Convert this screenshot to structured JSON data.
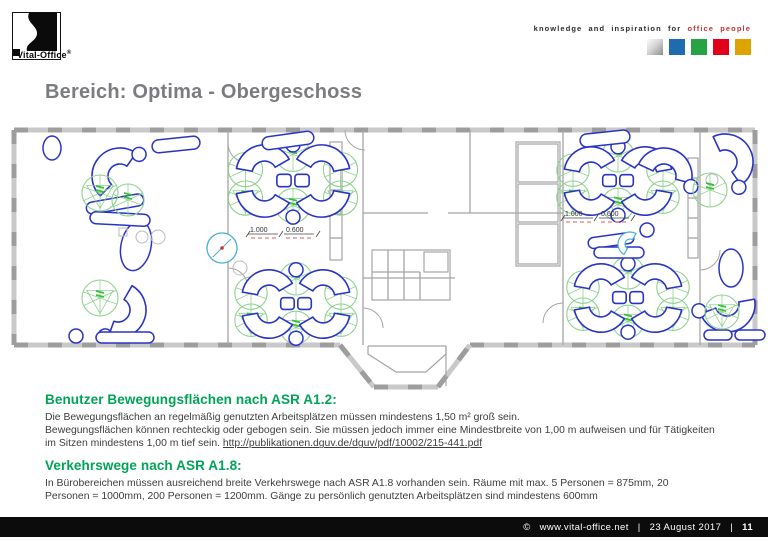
{
  "header": {
    "logo_text": "Vital-Office",
    "logo_reg": "®",
    "kicker_plain": "knowledge and inspiration for",
    "kicker_accent": "office people",
    "square_colors": [
      "silver",
      "#1e6bb0",
      "#27a244",
      "#e2001a",
      "#dda400"
    ]
  },
  "title": "Bereich: Optima - Obergeschoss",
  "sections": [
    {
      "heading": "Benutzer Bewegungsflächen nach ASR A1.2:",
      "line1": "Die Bewegungsflächen an regelmäßig genutzten Arbeitsplätzen müssen mindestens 1,50 m² groß sein.",
      "line2": "Bewegungsflächen können rechteckig oder gebogen sein. Sie müssen jedoch immer eine Mindestbreite von 1,00 m aufweisen und für Tätigkeiten",
      "line3_prefix": "im Sitzen mindestens 1,00 m tief sein. ",
      "link": "http://publikationen.dguv.de/dguv/pdf/10002/215-441.pdf"
    },
    {
      "heading": "Verkehrswege nach ASR A1.8:",
      "line1": "In Bürobereichen müssen ausreichend breite Verkehrswege nach ASR A1.8 vorhanden sein. Räume mit max. 5 Personen = 875mm, 20",
      "line2": "Personen = 1000mm, 200 Personen = 1200mm. Gänge zu persönlich genutzten Arbeitsplätzen sind mindestens 600mm"
    }
  ],
  "footer": {
    "copyright": "©",
    "site": "www.vital-office.net",
    "sep": "|",
    "date": "23 August 2017",
    "page": "11"
  },
  "colors": {
    "heading_green": "#00a455",
    "desk_blue": "#2a34c4",
    "zone_green": "#8ed28e",
    "zone_mark_green": "#38c038",
    "wall_gray": "#c9c9c9",
    "wall_dark": "#9d9d9d",
    "inner_gray": "#a5a5a5",
    "cyan": "#4ab0d2",
    "accent_red": "#cc3333"
  },
  "floorplan": {
    "walls": [
      [
        14,
        12,
        755,
        12
      ],
      [
        14,
        12,
        14,
        227
      ],
      [
        755,
        12,
        755,
        227
      ],
      [
        14,
        227,
        340,
        227
      ],
      [
        470,
        227,
        755,
        227
      ],
      [
        340,
        227,
        374,
        269
      ],
      [
        374,
        269,
        438,
        269
      ],
      [
        438,
        269,
        470,
        227
      ]
    ],
    "inner_walls": [
      [
        228,
        12,
        228,
        227
      ],
      [
        363,
        12,
        363,
        227
      ],
      [
        563,
        12,
        563,
        227
      ],
      [
        700,
        12,
        700,
        227
      ],
      [
        363,
        95,
        428,
        95
      ],
      [
        448,
        95,
        563,
        95
      ],
      [
        363,
        160,
        455,
        160
      ],
      [
        470,
        12,
        470,
        95
      ],
      [
        330,
        48,
        342,
        48
      ],
      [
        330,
        72,
        342,
        72
      ],
      [
        330,
        96,
        342,
        96
      ],
      [
        330,
        120,
        342,
        120
      ],
      [
        688,
        60,
        698,
        60
      ],
      [
        688,
        80,
        698,
        80
      ],
      [
        688,
        100,
        698,
        100
      ],
      [
        688,
        120,
        698,
        120
      ],
      [
        388,
        132,
        388,
        182
      ],
      [
        404,
        132,
        404,
        182
      ],
      [
        420,
        154,
        420,
        182
      ],
      [
        372,
        154,
        420,
        154
      ]
    ],
    "rects": [
      [
        330,
        24,
        12,
        118
      ],
      [
        516,
        24,
        44,
        124
      ],
      [
        518,
        26,
        40,
        38
      ],
      [
        518,
        66,
        40,
        38
      ],
      [
        518,
        106,
        40,
        40
      ],
      [
        688,
        40,
        10,
        100
      ],
      [
        372,
        132,
        78,
        50
      ],
      [
        424,
        134,
        24,
        20
      ]
    ],
    "plines": [
      [
        [
          368,
          228
        ],
        [
          368,
          236
        ],
        [
          396,
          254
        ],
        [
          426,
          254
        ],
        [
          446,
          236
        ],
        [
          446,
          228
        ]
      ],
      [
        [
          368,
          228
        ],
        [
          446,
          228
        ]
      ],
      [
        [
          446,
          228
        ],
        [
          446,
          268
        ]
      ]
    ],
    "doors": [
      "M345,12 A20,20 0 0 0 365,32",
      "M720,132 A20,20 0 0 1 700,152",
      "M228,25 A20,20 0 0 0 248,45",
      "M228,150 A20,20 0 0 1 248,170",
      "M363,190 A20,20 0 0 1 383,210",
      "M563,185 A20,20 0 0 0 543,205"
    ],
    "clusters": [
      {
        "type": "quad",
        "cx": 293,
        "cy": 63,
        "s": 0.95
      },
      {
        "type": "quad",
        "cx": 296,
        "cy": 186,
        "s": 0.9
      },
      {
        "type": "quad",
        "cx": 618,
        "cy": 63,
        "s": 0.9
      },
      {
        "type": "quad",
        "cx": 628,
        "cy": 180,
        "s": 0.9
      },
      {
        "type": "single",
        "cx": 120,
        "cy": 58,
        "rot": -15
      },
      {
        "type": "single",
        "cx": 118,
        "cy": 192,
        "rot": 150
      },
      {
        "type": "single",
        "cx": 664,
        "cy": 58,
        "rot": 55
      },
      {
        "type": "single",
        "cx": 725,
        "cy": 44,
        "rot": 95
      },
      {
        "type": "single",
        "cx": 727,
        "cy": 186,
        "rot": 200
      }
    ],
    "shapes": [
      {
        "t": "ellipse",
        "x": 52,
        "y": 30,
        "rx": 9,
        "ry": 12,
        "rot": 0
      },
      {
        "t": "ellipse",
        "x": 136,
        "y": 128,
        "rx": 15,
        "ry": 25,
        "rot": 12
      },
      {
        "t": "ellipse",
        "x": 731,
        "y": 150,
        "rx": 12,
        "ry": 19,
        "rot": 0
      },
      {
        "t": "rrect",
        "x": 86,
        "y": 80,
        "w": 58,
        "h": 12,
        "rot": -10
      },
      {
        "t": "rrect",
        "x": 90,
        "y": 95,
        "w": 60,
        "h": 12,
        "rot": 3
      },
      {
        "t": "rrect",
        "x": 96,
        "y": 214,
        "w": 58,
        "h": 11,
        "rot": 0
      },
      {
        "t": "rrect",
        "x": 152,
        "y": 20,
        "w": 48,
        "h": 13,
        "rot": -6
      },
      {
        "t": "rrect",
        "x": 262,
        "y": 16,
        "w": 52,
        "h": 13,
        "rot": -8
      },
      {
        "t": "rrect",
        "x": 580,
        "y": 14,
        "w": 50,
        "h": 13,
        "rot": -6
      },
      {
        "t": "rrect",
        "x": 588,
        "y": 117,
        "w": 46,
        "h": 11,
        "rot": -8
      },
      {
        "t": "rrect",
        "x": 594,
        "y": 129,
        "w": 50,
        "h": 11,
        "rot": 0
      },
      {
        "t": "rrect",
        "x": 704,
        "y": 212,
        "w": 28,
        "h": 10,
        "rot": 0
      },
      {
        "t": "rrect",
        "x": 735,
        "y": 212,
        "w": 30,
        "h": 10,
        "rot": 0
      },
      {
        "t": "chair",
        "x": 76,
        "y": 218
      },
      {
        "t": "chair",
        "x": 647,
        "y": 112
      },
      {
        "t": "gsq",
        "x": 123,
        "y": 114,
        "s": 8
      },
      {
        "t": "gcirc",
        "x": 142,
        "y": 119,
        "r": 6
      },
      {
        "t": "gcirc",
        "x": 158,
        "y": 119,
        "r": 7
      },
      {
        "t": "gcirc",
        "x": 240,
        "y": 150,
        "r": 7
      },
      {
        "t": "gcirc",
        "x": 712,
        "y": 62,
        "r": 6
      },
      {
        "t": "table",
        "x": 222,
        "y": 130,
        "r": 15
      },
      {
        "t": "cyanarc",
        "x": 630,
        "y": 126
      },
      {
        "t": "zone",
        "x": 100,
        "y": 75,
        "r": 18,
        "tri": true
      },
      {
        "t": "zone",
        "x": 128,
        "y": 82,
        "r": 16,
        "tri": false
      },
      {
        "t": "zone",
        "x": 100,
        "y": 180,
        "r": 18,
        "tri": true
      },
      {
        "t": "zone",
        "x": 710,
        "y": 72,
        "r": 17,
        "tri": false
      },
      {
        "t": "zone",
        "x": 722,
        "y": 194,
        "r": 17,
        "tri": true
      }
    ],
    "dims": [
      {
        "x": 248,
        "y": 106,
        "a": "1.000",
        "b": "0.600"
      },
      {
        "x": 563,
        "y": 90,
        "a": "1.000",
        "b": "0.600"
      }
    ]
  }
}
